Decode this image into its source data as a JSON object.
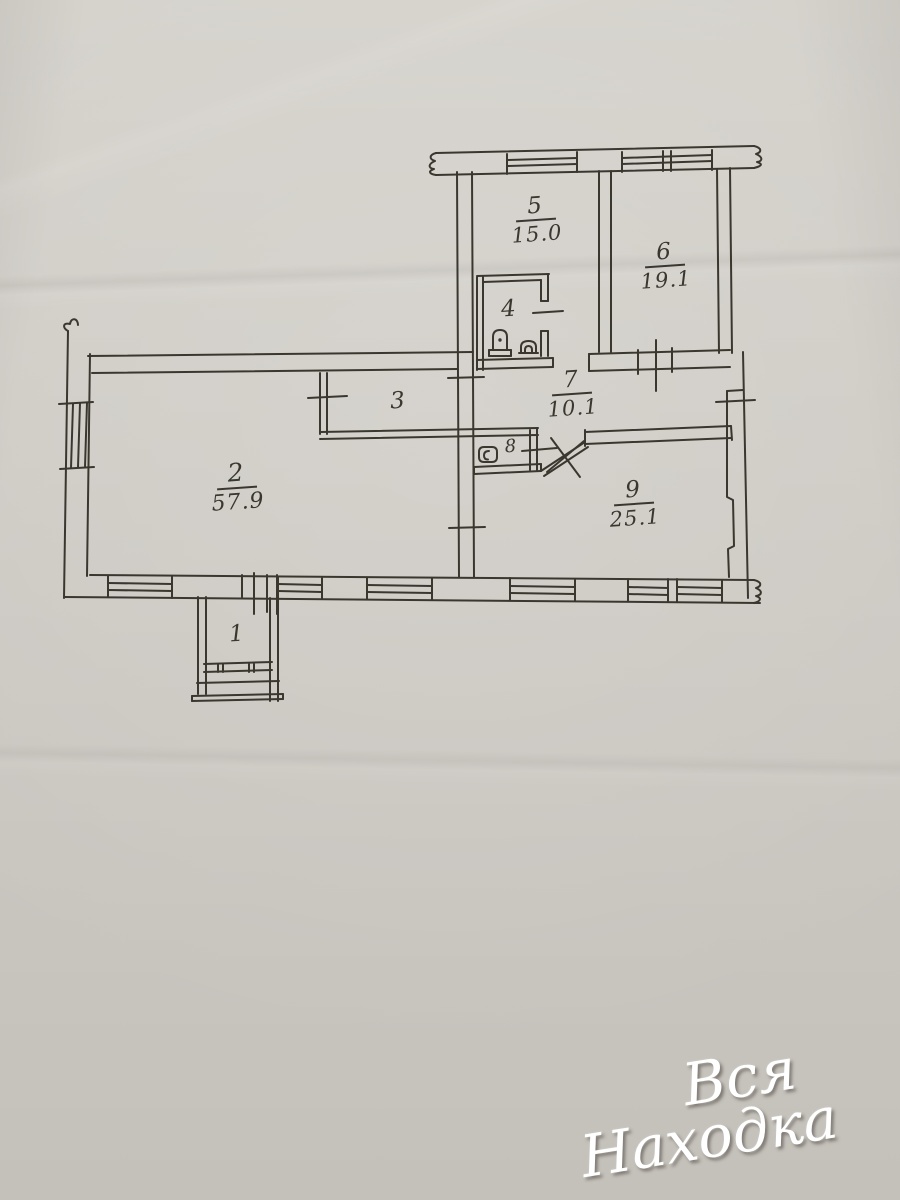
{
  "plan": {
    "rooms": {
      "r1": {
        "number": "1",
        "area": ""
      },
      "r2": {
        "number": "2",
        "area": "57.9"
      },
      "r3": {
        "number": "3",
        "area": ""
      },
      "r4": {
        "number": "4",
        "area": ""
      },
      "r5": {
        "number": "5",
        "area": "15.0"
      },
      "r6": {
        "number": "6",
        "area": "19.1"
      },
      "r7": {
        "number": "7",
        "area": "10.1"
      },
      "r8": {
        "number": "8",
        "area": ""
      },
      "r9": {
        "number": "9",
        "area": "25.1"
      }
    },
    "fixtures": {
      "room4": [
        "toilet-icon",
        "toilet-icon"
      ],
      "room8": [
        "sink-icon"
      ]
    }
  },
  "watermark": {
    "line1": "Вся",
    "line2": "Находка"
  },
  "colors": {
    "paper": "#cdc9c3",
    "ink": "#3a372f",
    "watermark": "#ffffff"
  }
}
